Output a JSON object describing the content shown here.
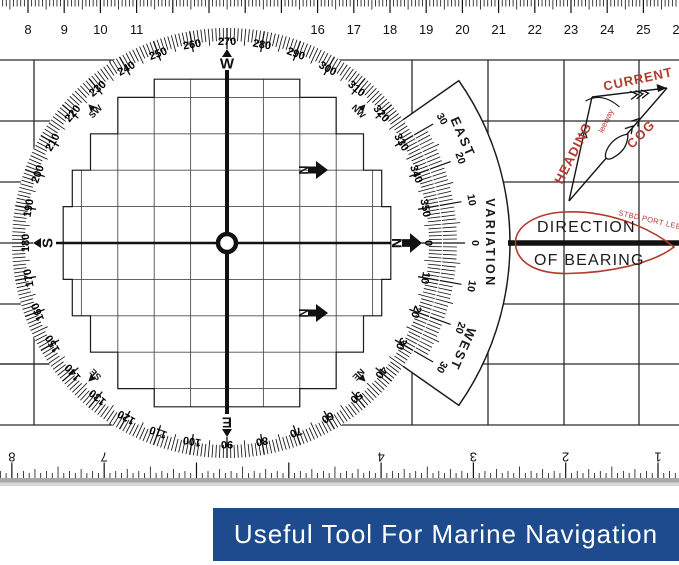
{
  "banner": {
    "label": "Useful Tool For Marine Navigation",
    "bg_color": "#1d4b8e",
    "text_color": "#ffffff"
  },
  "top_ruler": {
    "unit": "cm",
    "numbers": [
      8,
      9,
      10,
      11,
      16,
      17,
      18,
      19,
      20,
      21,
      22,
      23,
      24,
      25,
      26
    ]
  },
  "bottom_ruler": {
    "unit": "inch",
    "numbers": [
      8,
      7,
      4,
      3,
      2,
      1
    ]
  },
  "compass": {
    "degree_labels": [
      0,
      10,
      20,
      30,
      40,
      50,
      60,
      70,
      80,
      90,
      100,
      110,
      120,
      130,
      140,
      150,
      160,
      170,
      180,
      190,
      200,
      210,
      220,
      230,
      240,
      250,
      260,
      270,
      280,
      290,
      300,
      310,
      320,
      330,
      340,
      350
    ],
    "cardinals": [
      {
        "label": "N",
        "degrees": 0
      },
      {
        "label": "E",
        "degrees": 90
      },
      {
        "label": "S",
        "degrees": 180
      },
      {
        "label": "W",
        "degrees": 270
      }
    ],
    "intercardinals": [
      {
        "label": "NE",
        "degrees": 45
      },
      {
        "label": "SE",
        "degrees": 135
      },
      {
        "label": "SW",
        "degrees": 225
      },
      {
        "label": "NW",
        "degrees": 315
      }
    ]
  },
  "variation": {
    "title": "VARIATION",
    "east_label": "EAST",
    "west_label": "WEST",
    "tick_labels": [
      30,
      20,
      10,
      0,
      10,
      20,
      30
    ]
  },
  "bearing_tag": {
    "line1": "DIRECTION",
    "line2": "OF BEARING",
    "curved_text": "STBD PORT LEE",
    "color": "#b23a2e"
  },
  "vector_diagram": {
    "heading": "HEADING",
    "current": "CURRENT",
    "cog": "COG",
    "leeway": "leeway",
    "color": "#b23a2e"
  },
  "colors": {
    "ink": "#1a1a1a",
    "grid": "#2b2b2b",
    "inner_grid": "#4d4d4d"
  }
}
